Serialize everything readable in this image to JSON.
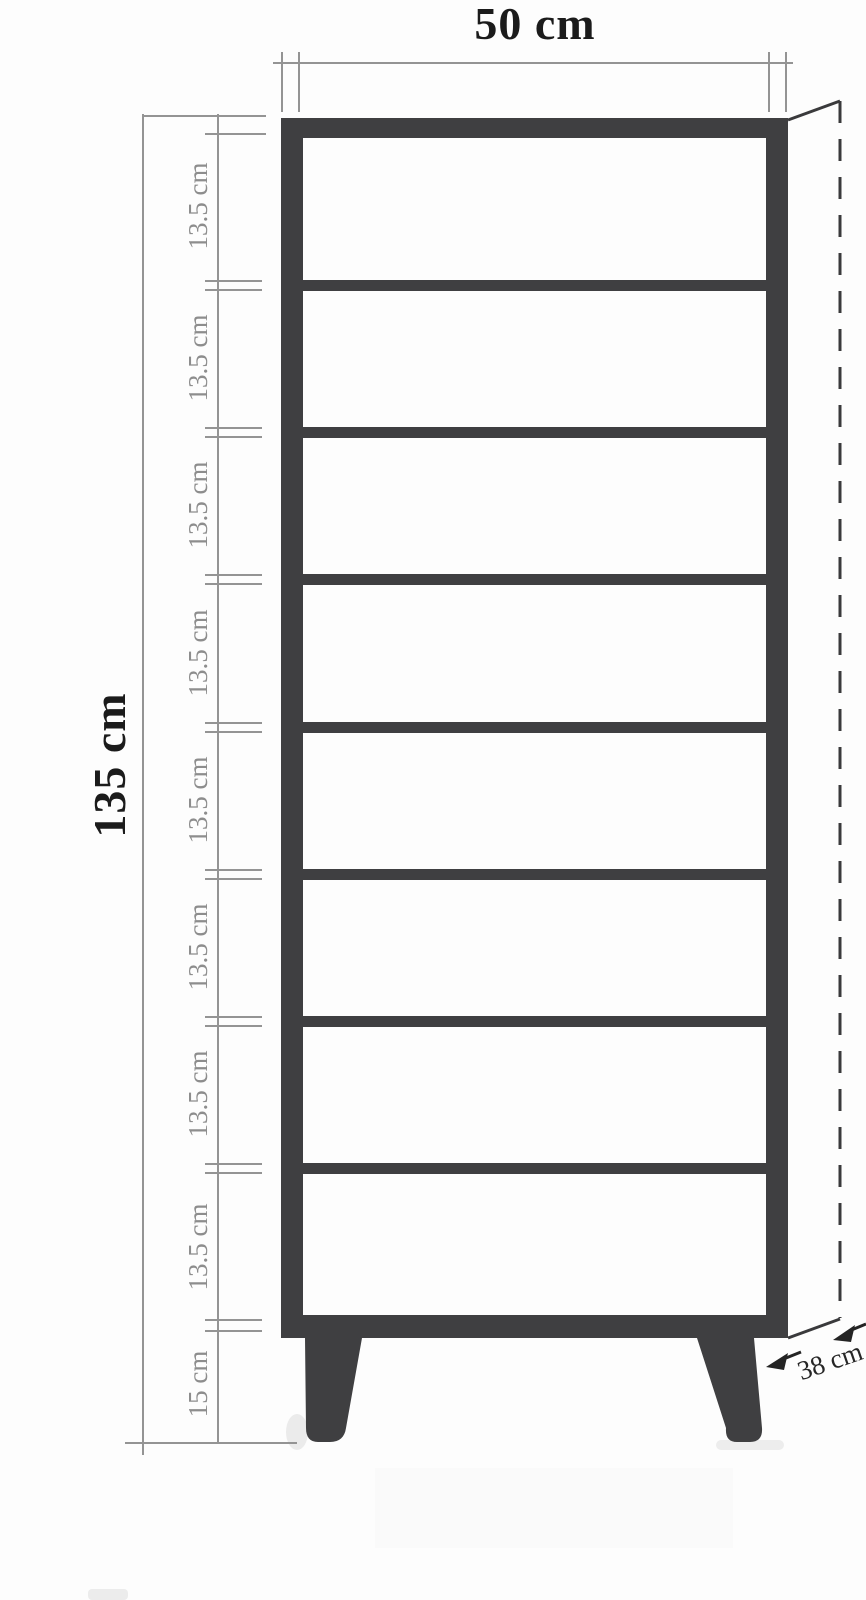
{
  "labels": {
    "width": "50 cm",
    "total_height": "135 cm",
    "depth": "38 cm",
    "leg_height": "15 cm",
    "segments": [
      "13.5 cm",
      "13.5 cm",
      "13.5 cm",
      "13.5 cm",
      "13.5 cm",
      "13.5 cm",
      "13.5 cm",
      "13.5 cm"
    ]
  },
  "structure": {
    "shelf_compartment_count": 8,
    "interior_shelf_count": 7,
    "leg_count": 2
  },
  "colors": {
    "cabinet": "#3f3f41",
    "dimension_lines": "#949494",
    "dimension_text_gray": "#8d8d8d",
    "dimension_text_dark": "#1b1b1b",
    "perspective_lines": "#3a3a3c",
    "depth_arrows": "#242424",
    "background": "#fdfdfd"
  }
}
